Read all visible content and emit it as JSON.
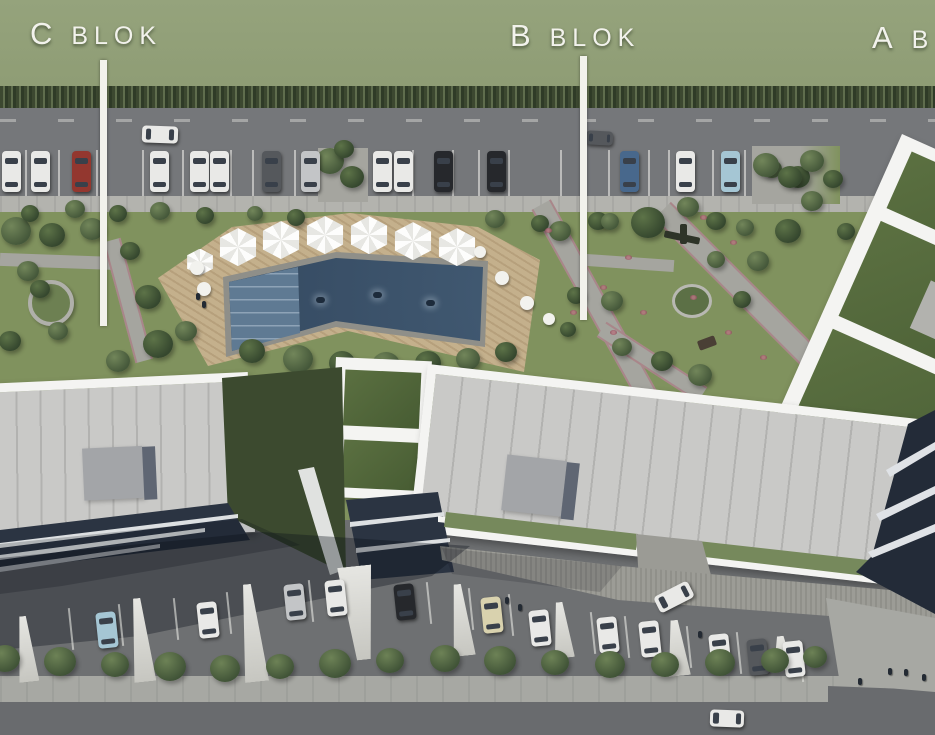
{
  "labels": {
    "c_blok": "C BLOK",
    "b_blok": "B BLOK",
    "a_blok_partial": "A B"
  },
  "colors": {
    "ui": {
      "grass": "#8e9c74",
      "hedge_a": "#3c4830",
      "hedge_b": "#5f6d4d",
      "road": "#75777a",
      "walk": "#b3b3ae",
      "lawn": "#80925e",
      "path": "#a5a59f",
      "deck": "#c4b08c",
      "pool_deep": "#32465d",
      "pool_shallow": "#5f7a93",
      "pool_edge": "#8f8f89",
      "roof": "#c9c9c7",
      "seam": "#b2b2b0",
      "trim": "#f4f4f2",
      "box": "#a3a5a8",
      "box_shade": "#5f6673",
      "groof": "#53683b",
      "court": "#3c4a2f",
      "facade": "#2b3442",
      "asphalt": "#6e7072",
      "divider": "#d8d8d4",
      "gstrip": "#76895c",
      "walk_b": "#a7a8a3",
      "road_b": "#696b6e",
      "label": "#f2f2ec",
      "glass": "#39404a"
    },
    "cars": {
      "white": "#e9e9e7",
      "black": "#26282c",
      "red": "#93372f",
      "blue": "#48688c",
      "lightblue": "#a5c6d4",
      "silver": "#c3c5c7",
      "beige": "#d9d2ae",
      "gray": "#55585c"
    }
  },
  "scene": {
    "top_cars": [
      [
        2,
        "white"
      ],
      [
        31,
        "white"
      ],
      [
        72,
        "red"
      ],
      [
        150,
        "white"
      ],
      [
        190,
        "white"
      ],
      [
        210,
        "white"
      ],
      [
        262,
        "gray"
      ],
      [
        301,
        "silver"
      ],
      [
        373,
        "white"
      ],
      [
        394,
        "white"
      ],
      [
        434,
        "black"
      ],
      [
        487,
        "black"
      ],
      [
        620,
        "blue"
      ],
      [
        676,
        "white"
      ],
      [
        721,
        "lightblue"
      ]
    ],
    "bottom_cars": [
      [
        97,
        612,
        "lightblue"
      ],
      [
        198,
        602,
        "white"
      ],
      [
        285,
        584,
        "silver"
      ],
      [
        326,
        580,
        "white"
      ],
      [
        395,
        584,
        "black"
      ],
      [
        482,
        597,
        "beige"
      ],
      [
        530,
        610,
        "white"
      ],
      [
        598,
        617,
        "white"
      ],
      [
        640,
        621,
        "white"
      ],
      [
        710,
        634,
        "white"
      ],
      [
        748,
        639,
        "gray"
      ],
      [
        784,
        641,
        "white"
      ]
    ],
    "moving_cars": [
      [
        142,
        126,
        36,
        17,
        "white",
        2
      ],
      [
        586,
        131,
        27,
        14,
        "gray",
        3
      ],
      [
        655,
        588,
        38,
        18,
        "white",
        -27
      ],
      [
        710,
        710,
        34,
        17,
        "white",
        2
      ]
    ],
    "umbrellas": [
      [
        200,
        262,
        30
      ],
      [
        238,
        247,
        42
      ],
      [
        281,
        240,
        42
      ],
      [
        325,
        235,
        42
      ],
      [
        369,
        235,
        42
      ],
      [
        413,
        241,
        42
      ],
      [
        457,
        247,
        42
      ]
    ],
    "deck_circles": [
      [
        197,
        268,
        7
      ],
      [
        204,
        289,
        7
      ],
      [
        480,
        252,
        6
      ],
      [
        502,
        278,
        7
      ],
      [
        527,
        303,
        7
      ],
      [
        549,
        319,
        6
      ]
    ],
    "swimmers": [
      [
        316,
        297
      ],
      [
        373,
        292
      ],
      [
        426,
        300
      ]
    ],
    "trees": [
      [
        16,
        232,
        15,
        0
      ],
      [
        52,
        236,
        13,
        1
      ],
      [
        92,
        230,
        12,
        0
      ],
      [
        130,
        252,
        10,
        1
      ],
      [
        28,
        272,
        11,
        0
      ],
      [
        148,
        298,
        13,
        1
      ],
      [
        58,
        332,
        10,
        0
      ],
      [
        158,
        345,
        15,
        1
      ],
      [
        118,
        362,
        12,
        0
      ],
      [
        10,
        342,
        11,
        1
      ],
      [
        186,
        332,
        11,
        0
      ],
      [
        40,
        290,
        10,
        1
      ],
      [
        252,
        352,
        13,
        1
      ],
      [
        298,
        360,
        15,
        0
      ],
      [
        342,
        364,
        13,
        1
      ],
      [
        386,
        366,
        14,
        0
      ],
      [
        428,
        364,
        13,
        1
      ],
      [
        468,
        360,
        12,
        0
      ],
      [
        506,
        353,
        11,
        1
      ],
      [
        560,
        232,
        11,
        0
      ],
      [
        598,
        222,
        10,
        1
      ],
      [
        648,
        224,
        17,
        1
      ],
      [
        688,
        208,
        11,
        0
      ],
      [
        576,
        296,
        9,
        1
      ],
      [
        612,
        302,
        11,
        0
      ],
      [
        568,
        330,
        8,
        1
      ],
      [
        622,
        348,
        10,
        0
      ],
      [
        662,
        362,
        11,
        1
      ],
      [
        700,
        376,
        12,
        0
      ],
      [
        742,
        300,
        9,
        1
      ],
      [
        758,
        262,
        11,
        0
      ],
      [
        788,
        232,
        13,
        1
      ],
      [
        812,
        202,
        11,
        0
      ],
      [
        798,
        178,
        12,
        1
      ],
      [
        772,
        170,
        10,
        0
      ],
      [
        846,
        232,
        9,
        1
      ],
      [
        716,
        260,
        9,
        0
      ],
      [
        30,
        214,
        9,
        1
      ],
      [
        75,
        210,
        10,
        0
      ],
      [
        118,
        214,
        9,
        1
      ],
      [
        160,
        212,
        10,
        0
      ],
      [
        205,
        216,
        9,
        1
      ],
      [
        255,
        214,
        8,
        0
      ],
      [
        296,
        218,
        9,
        1
      ],
      [
        495,
        220,
        10,
        0
      ],
      [
        540,
        224,
        9,
        1
      ],
      [
        610,
        222,
        9,
        0
      ],
      [
        716,
        222,
        10,
        1
      ],
      [
        745,
        228,
        9,
        0
      ]
    ],
    "street_trees": [
      [
        330,
        162,
        14,
        0
      ],
      [
        352,
        178,
        12,
        1
      ],
      [
        344,
        150,
        10,
        1
      ],
      [
        766,
        166,
        13,
        0
      ],
      [
        790,
        178,
        12,
        1
      ],
      [
        812,
        162,
        12,
        0
      ],
      [
        833,
        180,
        10,
        1
      ]
    ],
    "bushes_bottom": [
      [
        5,
        660,
        15
      ],
      [
        60,
        663,
        16
      ],
      [
        115,
        666,
        14
      ],
      [
        170,
        668,
        16
      ],
      [
        225,
        670,
        15
      ],
      [
        280,
        668,
        14
      ],
      [
        335,
        665,
        16
      ],
      [
        390,
        662,
        14
      ],
      [
        445,
        660,
        15
      ],
      [
        500,
        662,
        16
      ],
      [
        555,
        664,
        14
      ],
      [
        610,
        666,
        15
      ],
      [
        665,
        666,
        14
      ],
      [
        720,
        664,
        15
      ],
      [
        775,
        662,
        14
      ],
      [
        815,
        658,
        12
      ]
    ],
    "dividers": [
      [
        16,
        616,
        66,
        20,
        0
      ],
      [
        130,
        598,
        84,
        22,
        0
      ],
      [
        240,
        584,
        98,
        24,
        0
      ],
      [
        342,
        566,
        94,
        34,
        1
      ],
      [
        450,
        584,
        72,
        22,
        0
      ],
      [
        552,
        602,
        56,
        20,
        0
      ],
      [
        666,
        620,
        56,
        22,
        0
      ],
      [
        772,
        636,
        34,
        20,
        0
      ]
    ],
    "stall_lines_top": [
      25,
      58,
      96,
      142,
      182,
      230,
      252,
      294,
      412,
      452,
      478,
      508,
      560,
      608,
      648,
      668,
      712,
      744
    ],
    "stall_lines_bottom": [
      [
        70,
        608
      ],
      [
        120,
        604
      ],
      [
        175,
        598
      ],
      [
        228,
        592
      ],
      [
        310,
        580
      ],
      [
        428,
        582
      ],
      [
        470,
        588
      ],
      [
        510,
        594
      ],
      [
        592,
        612
      ],
      [
        626,
        616
      ],
      [
        688,
        626
      ],
      [
        738,
        632
      ],
      [
        800,
        640
      ]
    ],
    "people": [
      [
        505,
        597
      ],
      [
        518,
        604
      ],
      [
        858,
        678
      ],
      [
        888,
        668
      ],
      [
        904,
        669
      ],
      [
        922,
        674
      ],
      [
        698,
        631
      ],
      [
        196,
        293
      ],
      [
        202,
        301
      ]
    ],
    "flowers": [
      [
        580,
        250
      ],
      [
        600,
        285
      ],
      [
        570,
        310
      ],
      [
        640,
        310
      ],
      [
        690,
        295
      ],
      [
        725,
        330
      ],
      [
        760,
        355
      ],
      [
        700,
        215
      ],
      [
        730,
        240
      ],
      [
        625,
        255
      ],
      [
        545,
        228
      ],
      [
        610,
        330
      ]
    ]
  }
}
